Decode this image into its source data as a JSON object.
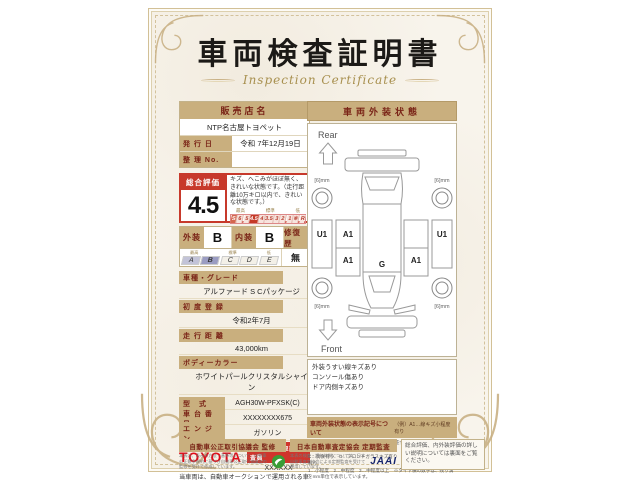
{
  "title": {
    "jp": "車両検査証明書",
    "en": "Inspection Certificate"
  },
  "colors": {
    "paper": "#f8f4ec",
    "gold": "#c9b185",
    "tan_bar": "#c9af7e",
    "maroon": "#7a2417",
    "red": "#c7392b",
    "toyota_red": "#e10c17",
    "scale_blue": "#9a9cc2",
    "jaai_navy": "#16246b",
    "aftc_green": "#3a9c35"
  },
  "dealer": {
    "header": "販売店名",
    "name": "NTP名古屋トヨペット",
    "issue_label": "発 行 日",
    "issue_value": "令和 7年12月19日",
    "ref_label": "整 理 No.",
    "ref_value": ""
  },
  "rating": {
    "label": "総合評価",
    "score": "4.5",
    "comment": "キズ、へこみがほぼ無く、きれいな状態です。（走行距離10万キロ以内で、きれいな状態です。）",
    "scale_labels": [
      "最高",
      "標準",
      "低"
    ],
    "scale": [
      "S",
      "6",
      "5",
      "4.5",
      "4",
      "3.5",
      "3",
      "2",
      "1",
      "※",
      "R"
    ],
    "selected": "4.5"
  },
  "grades": {
    "exterior_label": "外装",
    "exterior_value": "B",
    "interior_label": "内装",
    "interior_value": "B",
    "repair_label": "修復歴",
    "repair_value": "無",
    "scale_labels": [
      "最高",
      "標準",
      "低"
    ],
    "scale": [
      "A",
      "B",
      "C",
      "D",
      "E"
    ],
    "selected": "B"
  },
  "specs": [
    {
      "label": "車種・グレード",
      "value": "アルファード S Cパッケージ"
    },
    {
      "label": "初 度 登 録",
      "value": "令和2年7月"
    },
    {
      "label": "走 行 距 離",
      "value": "43,000km"
    },
    {
      "label": "ボディーカラー",
      "value": "ホワイトパールクリスタルシャイン"
    },
    {
      "label": "型　式",
      "value": "AGH30W-PFXSK(C)"
    },
    {
      "label": "車 台 番 号",
      "value": "XXXXXXXX675"
    },
    {
      "label": "エ ン ジ ン",
      "value": "ガソリン"
    }
  ],
  "inspector": {
    "brand": "TOYOTA",
    "badge": "トヨタ認定車両検査員",
    "number": "XXXXXX"
  },
  "footnote": "当車両は、自動車オークションで運用される車両評価基準に沿い、トヨタユーゼックが認定した検査員が厳正に検査・評価いたしました。",
  "exterior": {
    "header": "車両外装状態",
    "rear_label": "Rear",
    "front_label": "Front",
    "markers": [
      "U1",
      "A1",
      "A1",
      "G",
      "A1",
      "U1"
    ],
    "tires": [
      "[6]mm",
      "[6]mm",
      "[6]mm",
      "[6]mm"
    ],
    "notes": [
      "外装うすい線キズあり",
      "コンソール傷あり",
      "ドア内側キズあり"
    ],
    "legend": {
      "title": "車両外装状態の表示記号について",
      "example": "（例）A1…線キズ小程度有り",
      "lines": [
        "A…線キズ有り　U…へこみ有り　B…キズを伴うへこみ有り　P…要塗装　W…補修跡有り　S…サビ有り",
        "C…腐食有り　G…フロントガラスキズ有り　X…要交換　(X)…交換歴有り",
        "1…小程度　2…中程度　3…中程度以上　※タイヤ横の数字は、残り溝をmm単位で表示しています。"
      ]
    }
  },
  "bottom": {
    "box1": {
      "title": "自動車公正取引協議会 監修",
      "text": "本表は、表示の方法・基準等について、自動車公正競争規約に基づき自動車公正取引協議会の監修を受けて作成しています。"
    },
    "box2": {
      "title": "日本自動車査定協会 定期監査",
      "text": "本表の検査・評価体制については、日本自動車査定協会による定期監査を受けて運用しています。",
      "logo": "JAAI"
    },
    "box3": {
      "text": "総合評価、内外装評価の詳しい説明については裏面をご覧ください。"
    }
  }
}
